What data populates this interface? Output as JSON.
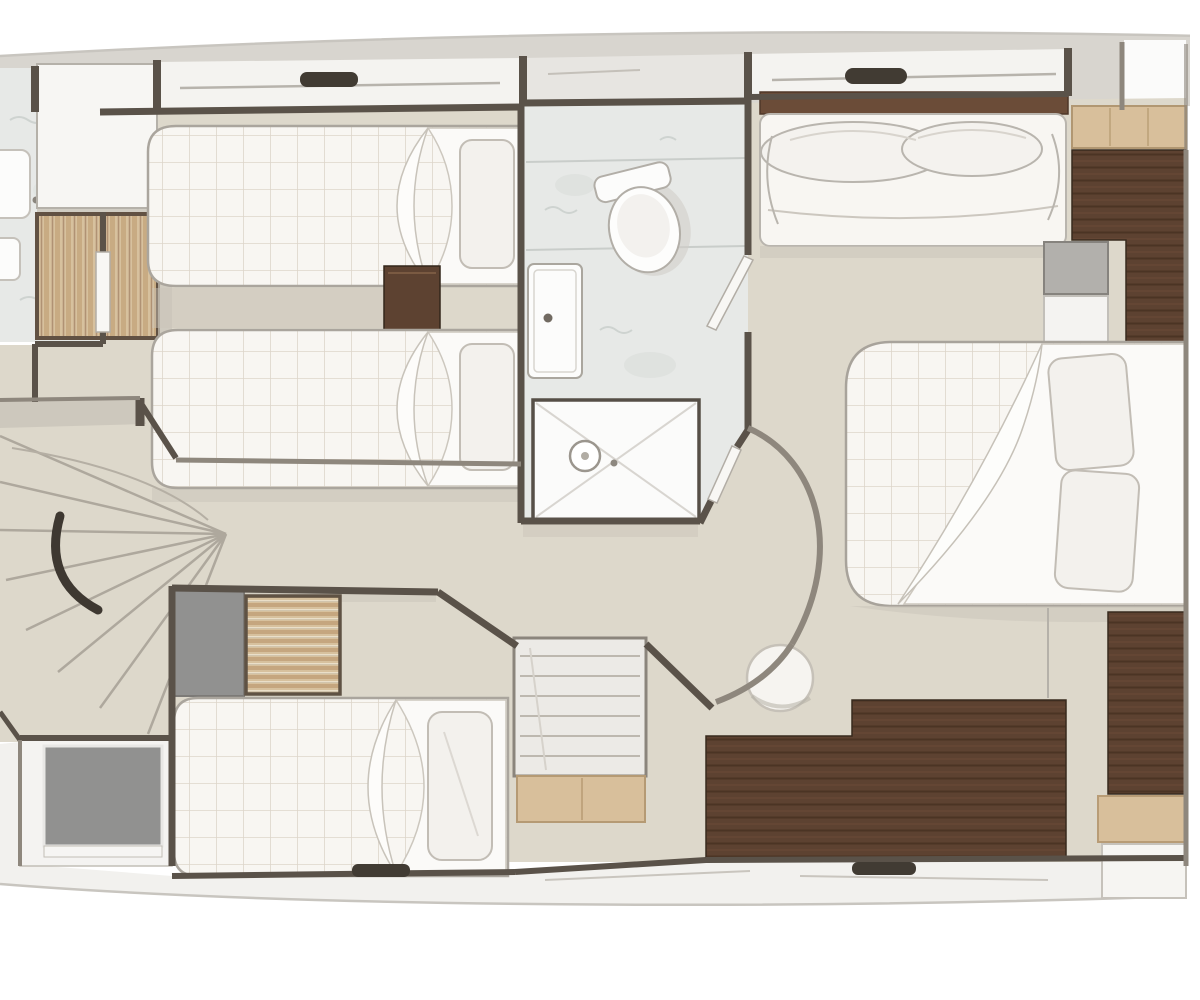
{
  "palette": {
    "page_bg": "#ffffff",
    "deck_band": "#d8d5cf",
    "hull_white_band": "#f4f3f0",
    "hull_gray_band": "#e7e5e1",
    "floor": "#ddd8cb",
    "floor_shadow": "#c9c4b9",
    "marble": "#e7e9e7",
    "white_room": "#f4f3f1",
    "mattress": "#f8f6f2",
    "sheet": "#fbfaf8",
    "pillow": "#f3f1ed",
    "wardrobe": "#d7c19e",
    "wood_dark": "#5d4231",
    "wood_light": "#d8bf9b",
    "wall": "#5a5249",
    "wall_light": "#8e877d",
    "gray_cabinet": "#919190",
    "gray_box": "#b2b0ac",
    "dark_fitting": "#413b33",
    "white_fixture": "#fcfcfb",
    "dark_rail": "#3e3831"
  },
  "plan": {
    "type": "yacht-deck-floor-plan",
    "view": "top-down",
    "rooms": [
      {
        "name": "twin-guest-cabin",
        "position": "top-left",
        "furniture": [
          "single-bed",
          "single-bed",
          "nightstand",
          "hanging-wardrobe",
          "cabinet"
        ]
      },
      {
        "name": "side-bathroom",
        "position": "far-left",
        "furniture": [
          "washbasin"
        ]
      },
      {
        "name": "central-bathroom",
        "position": "center",
        "furniture": [
          "toilet",
          "vanity-washbasin",
          "shower"
        ]
      },
      {
        "name": "staircase",
        "position": "left",
        "furniture": [
          "fan-steps",
          "handrail"
        ]
      },
      {
        "name": "side-room",
        "position": "bottom-left",
        "furniture": [
          "berth"
        ]
      },
      {
        "name": "guest-cabin",
        "position": "bottom-center",
        "furniture": [
          "bed",
          "hanging-wardrobe",
          "gray-cabinet",
          "shelf-unit",
          "bench"
        ]
      },
      {
        "name": "master-cabin",
        "position": "right",
        "furniture": [
          "double-bed",
          "sofa",
          "dresser",
          "l-shaped-cabinet",
          "stool",
          "side-cabinet"
        ]
      }
    ]
  }
}
